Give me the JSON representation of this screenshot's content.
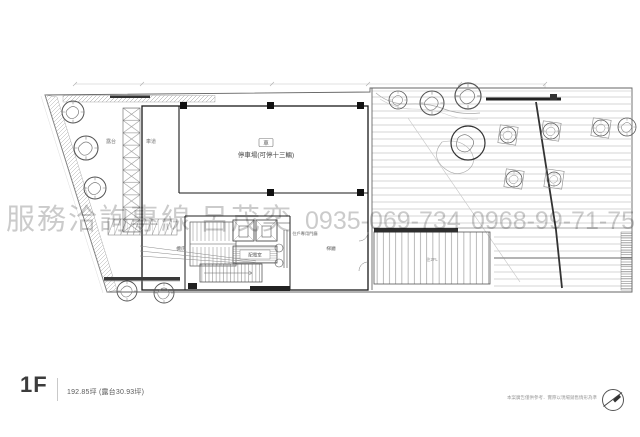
{
  "watermark": {
    "service_label": "服務洽詢專線",
    "agent_name": "呂茂奕",
    "phone_primary": "0935-069-734",
    "phone_secondary": "0968-99-71-75",
    "color": "#c6c6c6"
  },
  "footer": {
    "floor_label": "1F",
    "area_text": "192.85坪 (露台30.93坪)"
  },
  "footnote": {
    "disclaimer": "本案廣告僅供參考．實際以現場銷售情形為準"
  },
  "plan": {
    "labels": {
      "terrace": "露台",
      "driveway": "車道",
      "garage_icon": "車",
      "garage": "停車場(可停十三輛)",
      "equipment_room": "機房",
      "generator_room": "配電室",
      "entry_lobby": "住戶專用門廳",
      "elevator_lobby": "梯廳",
      "stair_note": "往2FL"
    }
  }
}
